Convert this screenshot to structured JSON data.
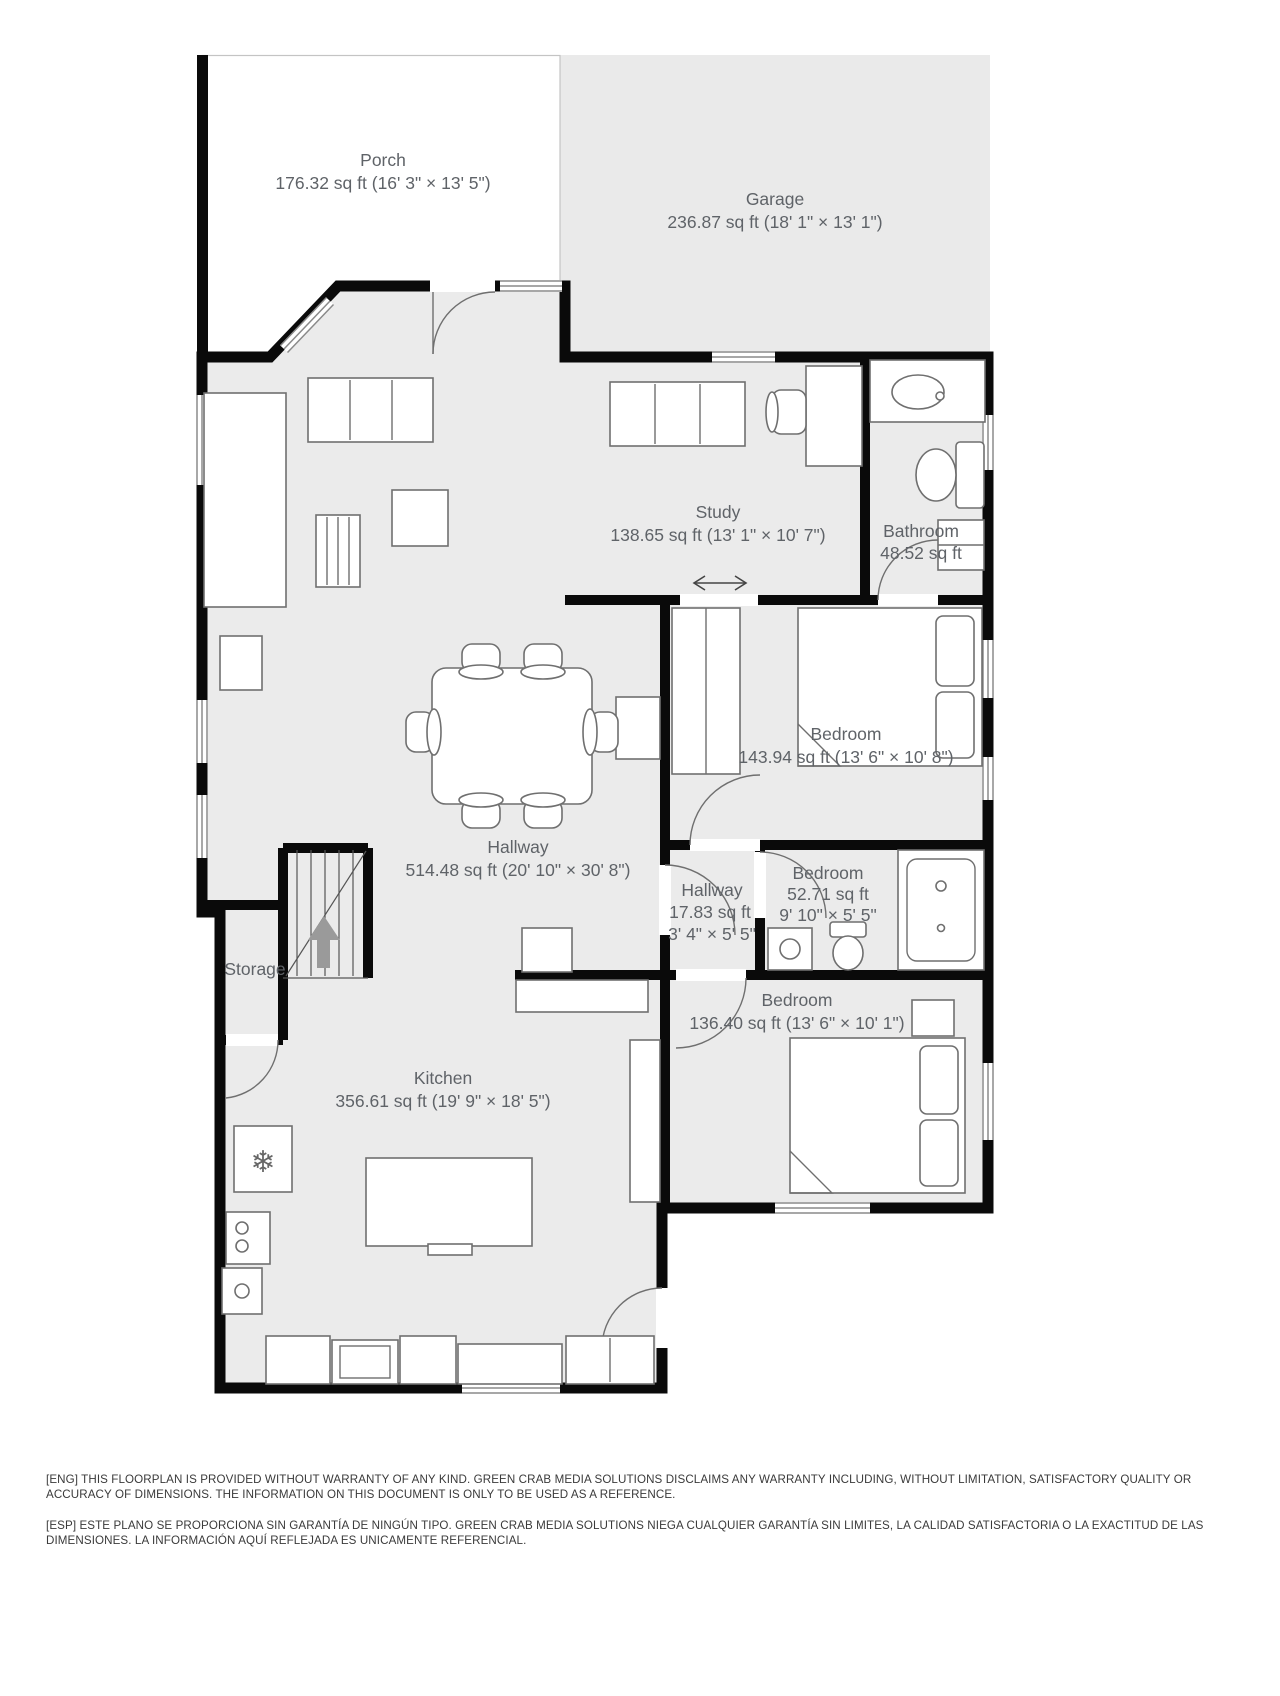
{
  "colors": {
    "floor_fill": "#ebebeb",
    "garage_fill": "#eaeaea",
    "porch_fill": "#ffffff",
    "wall": "#0a0a0a",
    "furniture_stroke": "#6f6f6f",
    "label_text": "#5f6368",
    "arrow_fill": "#9a9a9a"
  },
  "rooms": [
    {
      "name": "Porch",
      "area": "176.32 sq ft (16' 3\" × 13' 5\")"
    },
    {
      "name": "Garage",
      "area": "236.87 sq ft (18' 1\" × 13' 1\")"
    },
    {
      "name": "Study",
      "area": "138.65 sq ft (13' 1\" × 10' 7\")"
    },
    {
      "name": "Bathroom",
      "area": "48.52 sq ft"
    },
    {
      "name": "Bedroom",
      "area": "143.94 sq ft (13' 6\" × 10' 8\")"
    },
    {
      "name": "Hallway",
      "area": "514.48 sq ft (20' 10\" × 30' 8\")"
    },
    {
      "name": "Hallway",
      "area": "17.83 sq ft",
      "dims": "3' 4\" × 5' 5\""
    },
    {
      "name": "Bedroom",
      "area": "52.71 sq ft",
      "dims": "9' 10\" × 5' 5\""
    },
    {
      "name": "Bedroom",
      "area": "136.40 sq ft (13' 6\" × 10' 1\")"
    },
    {
      "name": "Storage"
    },
    {
      "name": "Kitchen",
      "area": "356.61 sq ft (19' 9\" × 18' 5\")"
    }
  ],
  "glyphs": {
    "fridge_snowflake": "❄"
  },
  "disclaimer": {
    "eng": "[ENG] THIS FLOORPLAN IS PROVIDED WITHOUT WARRANTY OF ANY KIND. GREEN CRAB MEDIA SOLUTIONS DISCLAIMS ANY WARRANTY INCLUDING, WITHOUT LIMITATION, SATISFACTORY QUALITY OR ACCURACY OF DIMENSIONS. THE INFORMATION ON THIS DOCUMENT IS ONLY TO BE USED AS A REFERENCE.",
    "esp": "[ESP] ESTE PLANO SE PROPORCIONA SIN GARANTÍA DE NINGÚN TIPO. GREEN CRAB MEDIA SOLUTIONS NIEGA CUALQUIER GARANTÍA SIN LIMITES, LA CALIDAD SATISFACTORIA O LA EXACTITUD DE LAS DIMENSIONES. LA INFORMACIÓN AQUÍ REFLEJADA ES UNICAMENTE REFERENCIAL."
  }
}
